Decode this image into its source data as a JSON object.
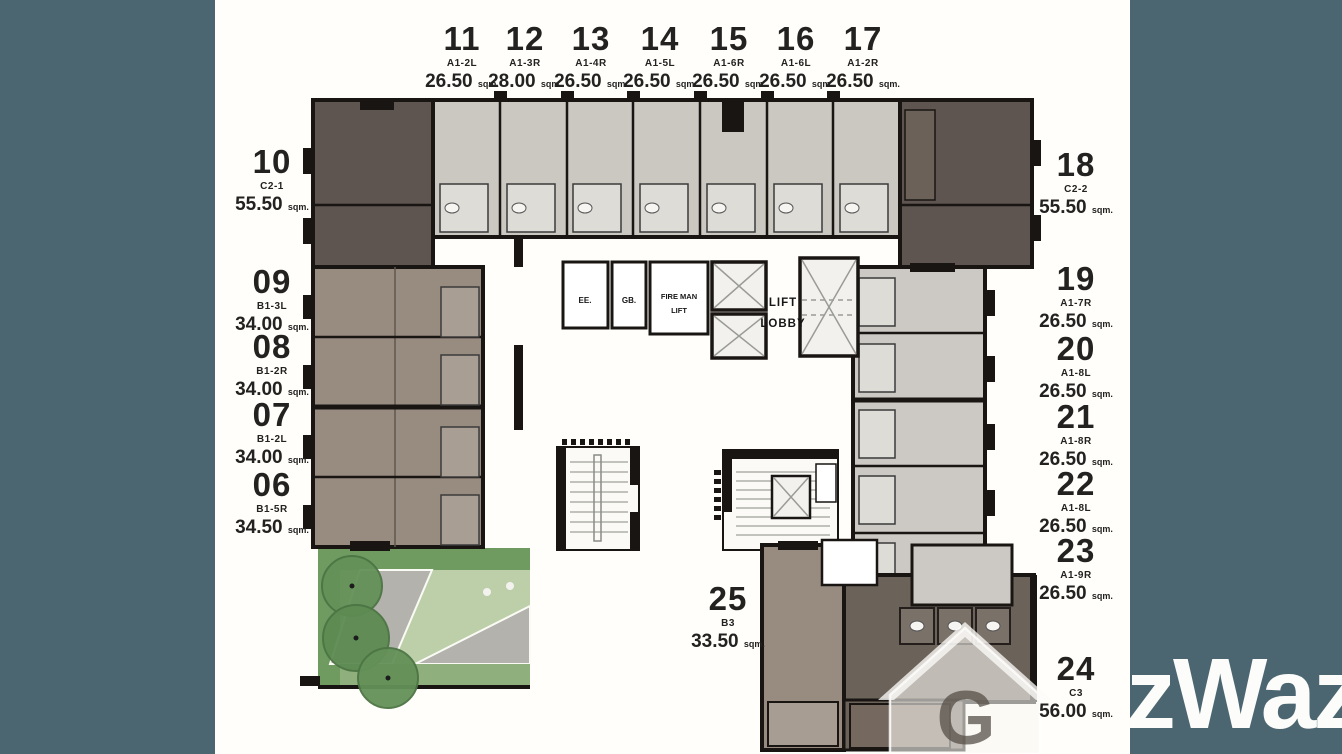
{
  "area_unit": "sqm.",
  "watermark": {
    "text": "zWaz",
    "house_letter": "G"
  },
  "core": {
    "ee": "EE.",
    "gb": "GB.",
    "fireman": "FIRE MAN\nLIFT",
    "lobby": "LIFT\nLOBBY"
  },
  "units": {
    "top": [
      {
        "no": "11",
        "type": "A1-2L",
        "area": "26.50"
      },
      {
        "no": "12",
        "type": "A1-3R",
        "area": "28.00"
      },
      {
        "no": "13",
        "type": "A1-4R",
        "area": "26.50"
      },
      {
        "no": "14",
        "type": "A1-5L",
        "area": "26.50"
      },
      {
        "no": "15",
        "type": "A1-6R",
        "area": "26.50"
      },
      {
        "no": "16",
        "type": "A1-6L",
        "area": "26.50"
      },
      {
        "no": "17",
        "type": "A1-2R",
        "area": "26.50"
      }
    ],
    "left": [
      {
        "no": "10",
        "type": "C2-1",
        "area": "55.50"
      },
      {
        "no": "09",
        "type": "B1-3L",
        "area": "34.00"
      },
      {
        "no": "08",
        "type": "B1-2R",
        "area": "34.00"
      },
      {
        "no": "07",
        "type": "B1-2L",
        "area": "34.00"
      },
      {
        "no": "06",
        "type": "B1-5R",
        "area": "34.50"
      }
    ],
    "right": [
      {
        "no": "18",
        "type": "C2-2",
        "area": "55.50"
      },
      {
        "no": "19",
        "type": "A1-7R",
        "area": "26.50"
      },
      {
        "no": "20",
        "type": "A1-8L",
        "area": "26.50"
      },
      {
        "no": "21",
        "type": "A1-8R",
        "area": "26.50"
      },
      {
        "no": "22",
        "type": "A1-8L",
        "area": "26.50"
      },
      {
        "no": "23",
        "type": "A1-9R",
        "area": "26.50"
      },
      {
        "no": "24",
        "type": "C3",
        "area": "56.00"
      }
    ],
    "bottom": [
      {
        "no": "25",
        "type": "B3",
        "area": "33.50"
      }
    ]
  },
  "colors": {
    "background": "#4b6670",
    "paper": "#fffefb",
    "dark_unit": "#5e5550",
    "taupe_unit": "#988c81",
    "light_unit": "#cbc8c2",
    "wall": "#181512",
    "garden_green": "#6f9b60",
    "lawn": "#bccfa9",
    "path_gray": "#b4b2ac",
    "watermark": "#fcfcfa"
  }
}
